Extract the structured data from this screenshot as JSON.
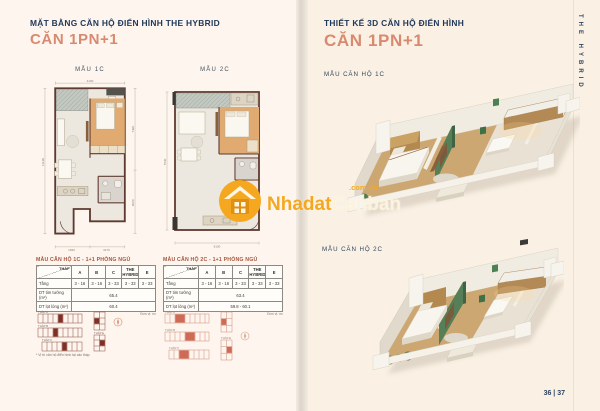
{
  "colors": {
    "navy": "#21395b",
    "coral": "#d88a70",
    "table_title_red": "#a8543e",
    "watermark_orange": "#f5a81f",
    "plan_wall_brown": "#5e3a31",
    "bedroom_tan": "#e0aa70",
    "render_green": "#567f58"
  },
  "left_page": {
    "title": "MẶT BẰNG CĂN HỘ ĐIỂN HÌNH THE HYBRID",
    "subtitle": "CĂN 1PN+1",
    "plan1": {
      "label": "MẪU 1C",
      "dims": {
        "top": "4100",
        "left": "11190",
        "right_top": "7420",
        "right_bottom": "2020",
        "bottom_left": "1520",
        "bottom_right": "4170"
      }
    },
    "plan2": {
      "label": "MẪU 2C",
      "dims": {
        "left": "7040",
        "bottom": "8100"
      }
    },
    "tables": {
      "corner": "THÁP",
      "columns": [
        "A",
        "B",
        "C",
        "THE HYBRID",
        "E"
      ],
      "row_labels": {
        "floor": "Tầng",
        "gross": "DT tim tường (m²)",
        "net": "DT lọt lòng (m²)"
      },
      "table1": {
        "title": "MẪU CĂN HỘ 1C - 1+1 PHÒNG NGỦ",
        "floors": [
          "3 - 16",
          "3 - 16",
          "3 - 33",
          "3 - 33",
          "3 - 33"
        ],
        "gross": "65.4",
        "net": "60.4",
        "note": "Đơn vị: m²"
      },
      "table2": {
        "title": "MẪU CĂN HỘ 2C - 1+1 PHÒNG NGỦ",
        "floors": [
          "3 - 16",
          "3 - 16",
          "3 - 33",
          "3 - 33",
          "3 - 33"
        ],
        "gross": "63.4",
        "net": "59.8 - 60.1",
        "note": "Đơn vị: m²"
      }
    },
    "keyplans": {
      "labels": [
        "THÁP A",
        "THÁP B",
        "THÁP C",
        "THÁP E"
      ],
      "note": "* Vị trí căn hộ điển hình tại các tháp"
    }
  },
  "right_page": {
    "title": "THIẾT KẾ 3D CĂN HỘ ĐIỂN HÌNH",
    "subtitle": "CĂN 1PN+1",
    "render1_label": "MẪU CĂN HỘ 1C",
    "render2_label": "MẪU CĂN HỘ 2C",
    "side_text": "THE HYBRID",
    "page_number": "36 | 37"
  },
  "watermark": {
    "brand_bold": "Nhadat",
    "brand_light": "Canban",
    "domain": ".com.vn"
  }
}
